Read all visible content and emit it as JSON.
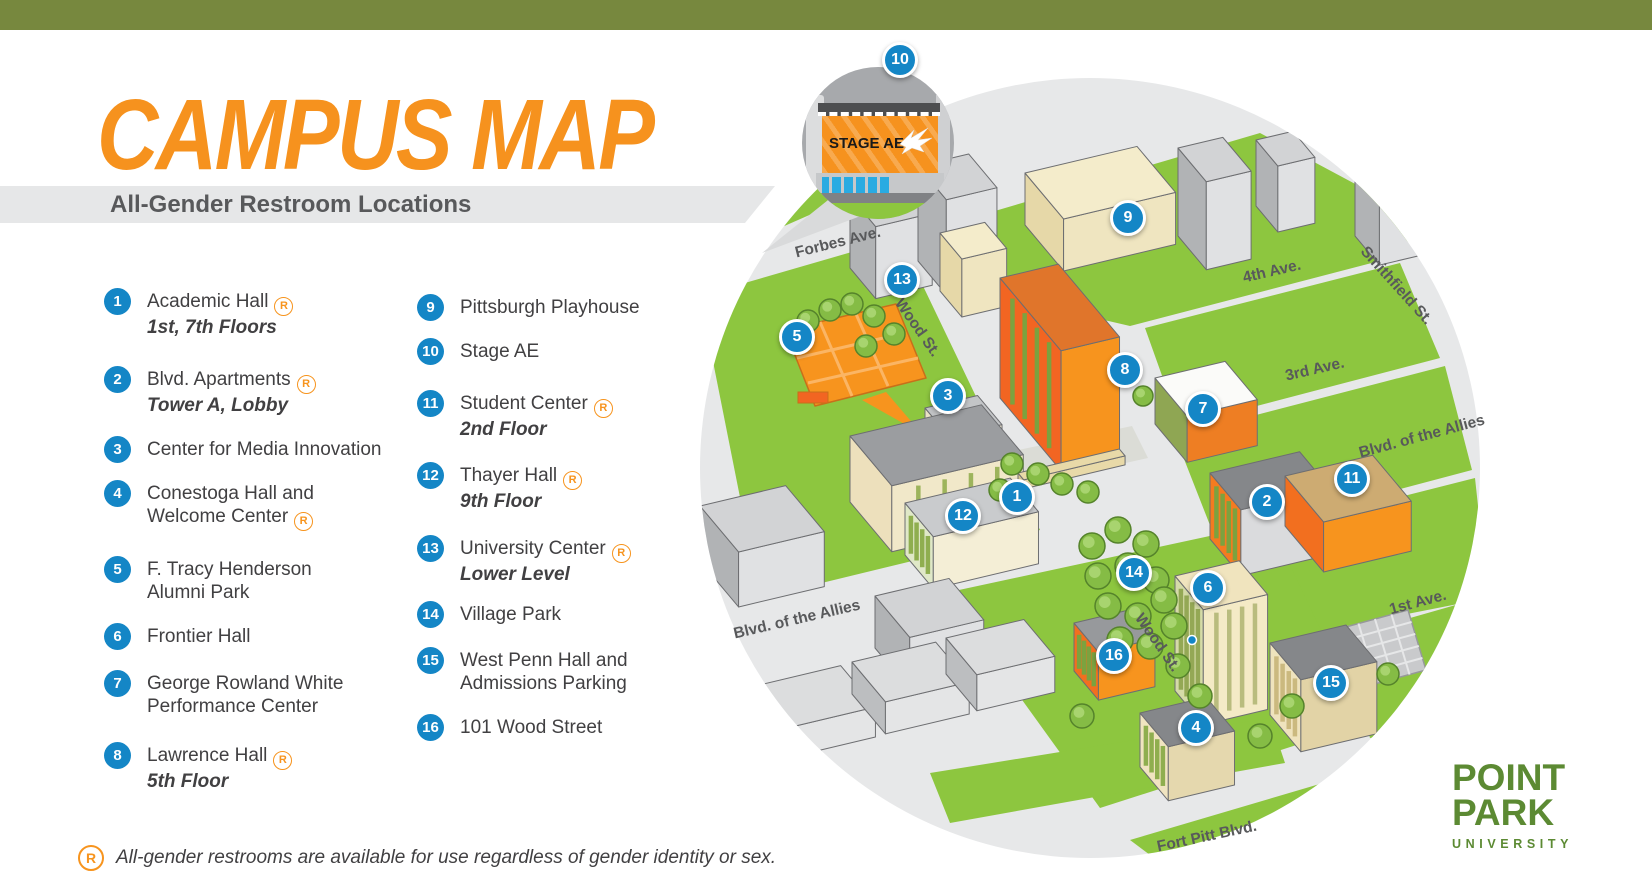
{
  "header": {
    "title": "CAMPUS MAP",
    "subtitle": "All-Gender Restroom Locations"
  },
  "legend": {
    "items": [
      {
        "n": "1",
        "name": "Academic Hall",
        "r": true,
        "sub": "1st, 7th Floors"
      },
      {
        "n": "2",
        "name": "Blvd. Apartments",
        "r": true,
        "sub": "Tower A, Lobby"
      },
      {
        "n": "3",
        "name": "Center for Media Innovation",
        "r": false,
        "sub": ""
      },
      {
        "n": "4",
        "name": "Conestoga Hall and\nWelcome Center",
        "r": true,
        "sub": ""
      },
      {
        "n": "5",
        "name": "F. Tracy Henderson\nAlumni Park",
        "r": false,
        "sub": ""
      },
      {
        "n": "6",
        "name": "Frontier Hall",
        "r": false,
        "sub": ""
      },
      {
        "n": "7",
        "name": "George Rowland White\nPerformance Center",
        "r": false,
        "sub": ""
      },
      {
        "n": "8",
        "name": "Lawrence Hall",
        "r": true,
        "sub": "5th Floor"
      },
      {
        "n": "9",
        "name": "Pittsburgh Playhouse",
        "r": false,
        "sub": ""
      },
      {
        "n": "10",
        "name": "Stage AE",
        "r": false,
        "sub": ""
      },
      {
        "n": "11",
        "name": "Student Center",
        "r": true,
        "sub": "2nd Floor"
      },
      {
        "n": "12",
        "name": "Thayer Hall",
        "r": true,
        "sub": "9th Floor"
      },
      {
        "n": "13",
        "name": "University Center",
        "r": true,
        "sub": "Lower Level"
      },
      {
        "n": "14",
        "name": "Village Park",
        "r": false,
        "sub": ""
      },
      {
        "n": "15",
        "name": "West Penn Hall and\nAdmissions Parking",
        "r": false,
        "sub": ""
      },
      {
        "n": "16",
        "name": "101 Wood Street",
        "r": false,
        "sub": ""
      }
    ],
    "restroom_symbol": "R"
  },
  "footnote": {
    "symbol": "R",
    "text": "All-gender restrooms are available for use regardless of gender identity or sex."
  },
  "map": {
    "street_labels": [
      {
        "text": "Forbes Ave.",
        "x": 838,
        "y": 243,
        "rot": -14
      },
      {
        "text": "Wood St.",
        "x": 917,
        "y": 328,
        "rot": 55
      },
      {
        "text": "4th Ave.",
        "x": 1272,
        "y": 272,
        "rot": -13
      },
      {
        "text": "Smithfield St.",
        "x": 1396,
        "y": 286,
        "rot": 48
      },
      {
        "text": "3rd Ave.",
        "x": 1315,
        "y": 370,
        "rot": -13
      },
      {
        "text": "Blvd. of the Allies",
        "x": 1422,
        "y": 437,
        "rot": -15
      },
      {
        "text": "Blvd. of the Allies",
        "x": 797,
        "y": 620,
        "rot": -13
      },
      {
        "text": "1st Ave.",
        "x": 1418,
        "y": 603,
        "rot": -15
      },
      {
        "text": "Wood St.",
        "x": 1157,
        "y": 643,
        "rot": 55
      },
      {
        "text": "Fort Pitt Blvd.",
        "x": 1207,
        "y": 837,
        "rot": -12
      }
    ],
    "markers": [
      {
        "n": "10",
        "x": 900,
        "y": 60
      },
      {
        "n": "9",
        "x": 1128,
        "y": 218
      },
      {
        "n": "13",
        "x": 902,
        "y": 280
      },
      {
        "n": "5",
        "x": 797,
        "y": 337
      },
      {
        "n": "8",
        "x": 1125,
        "y": 370
      },
      {
        "n": "3",
        "x": 948,
        "y": 396
      },
      {
        "n": "7",
        "x": 1203,
        "y": 409
      },
      {
        "n": "11",
        "x": 1352,
        "y": 479
      },
      {
        "n": "1",
        "x": 1017,
        "y": 497
      },
      {
        "n": "2",
        "x": 1267,
        "y": 502
      },
      {
        "n": "12",
        "x": 963,
        "y": 516
      },
      {
        "n": "14",
        "x": 1134,
        "y": 573
      },
      {
        "n": "6",
        "x": 1208,
        "y": 588
      },
      {
        "n": "16",
        "x": 1114,
        "y": 656
      },
      {
        "n": "15",
        "x": 1331,
        "y": 683
      },
      {
        "n": "4",
        "x": 1196,
        "y": 728
      }
    ],
    "inset": {
      "billboard_text": "STAGE AE"
    }
  },
  "logo": {
    "line1": "POINT",
    "line2": "PARK",
    "line3": "UNIVERSITY"
  },
  "colors": {
    "top_bar_olive": "#77883E",
    "title_orange": "#F6921E",
    "subtitle_gray": "#58595B",
    "legend_text": "#414042",
    "marker_blue": "#1486C6",
    "restroom_orange": "#F7941E",
    "map_green": "#8DC63F",
    "street_gray": "#E7E8E9",
    "logo_green": "#5C8A33"
  }
}
